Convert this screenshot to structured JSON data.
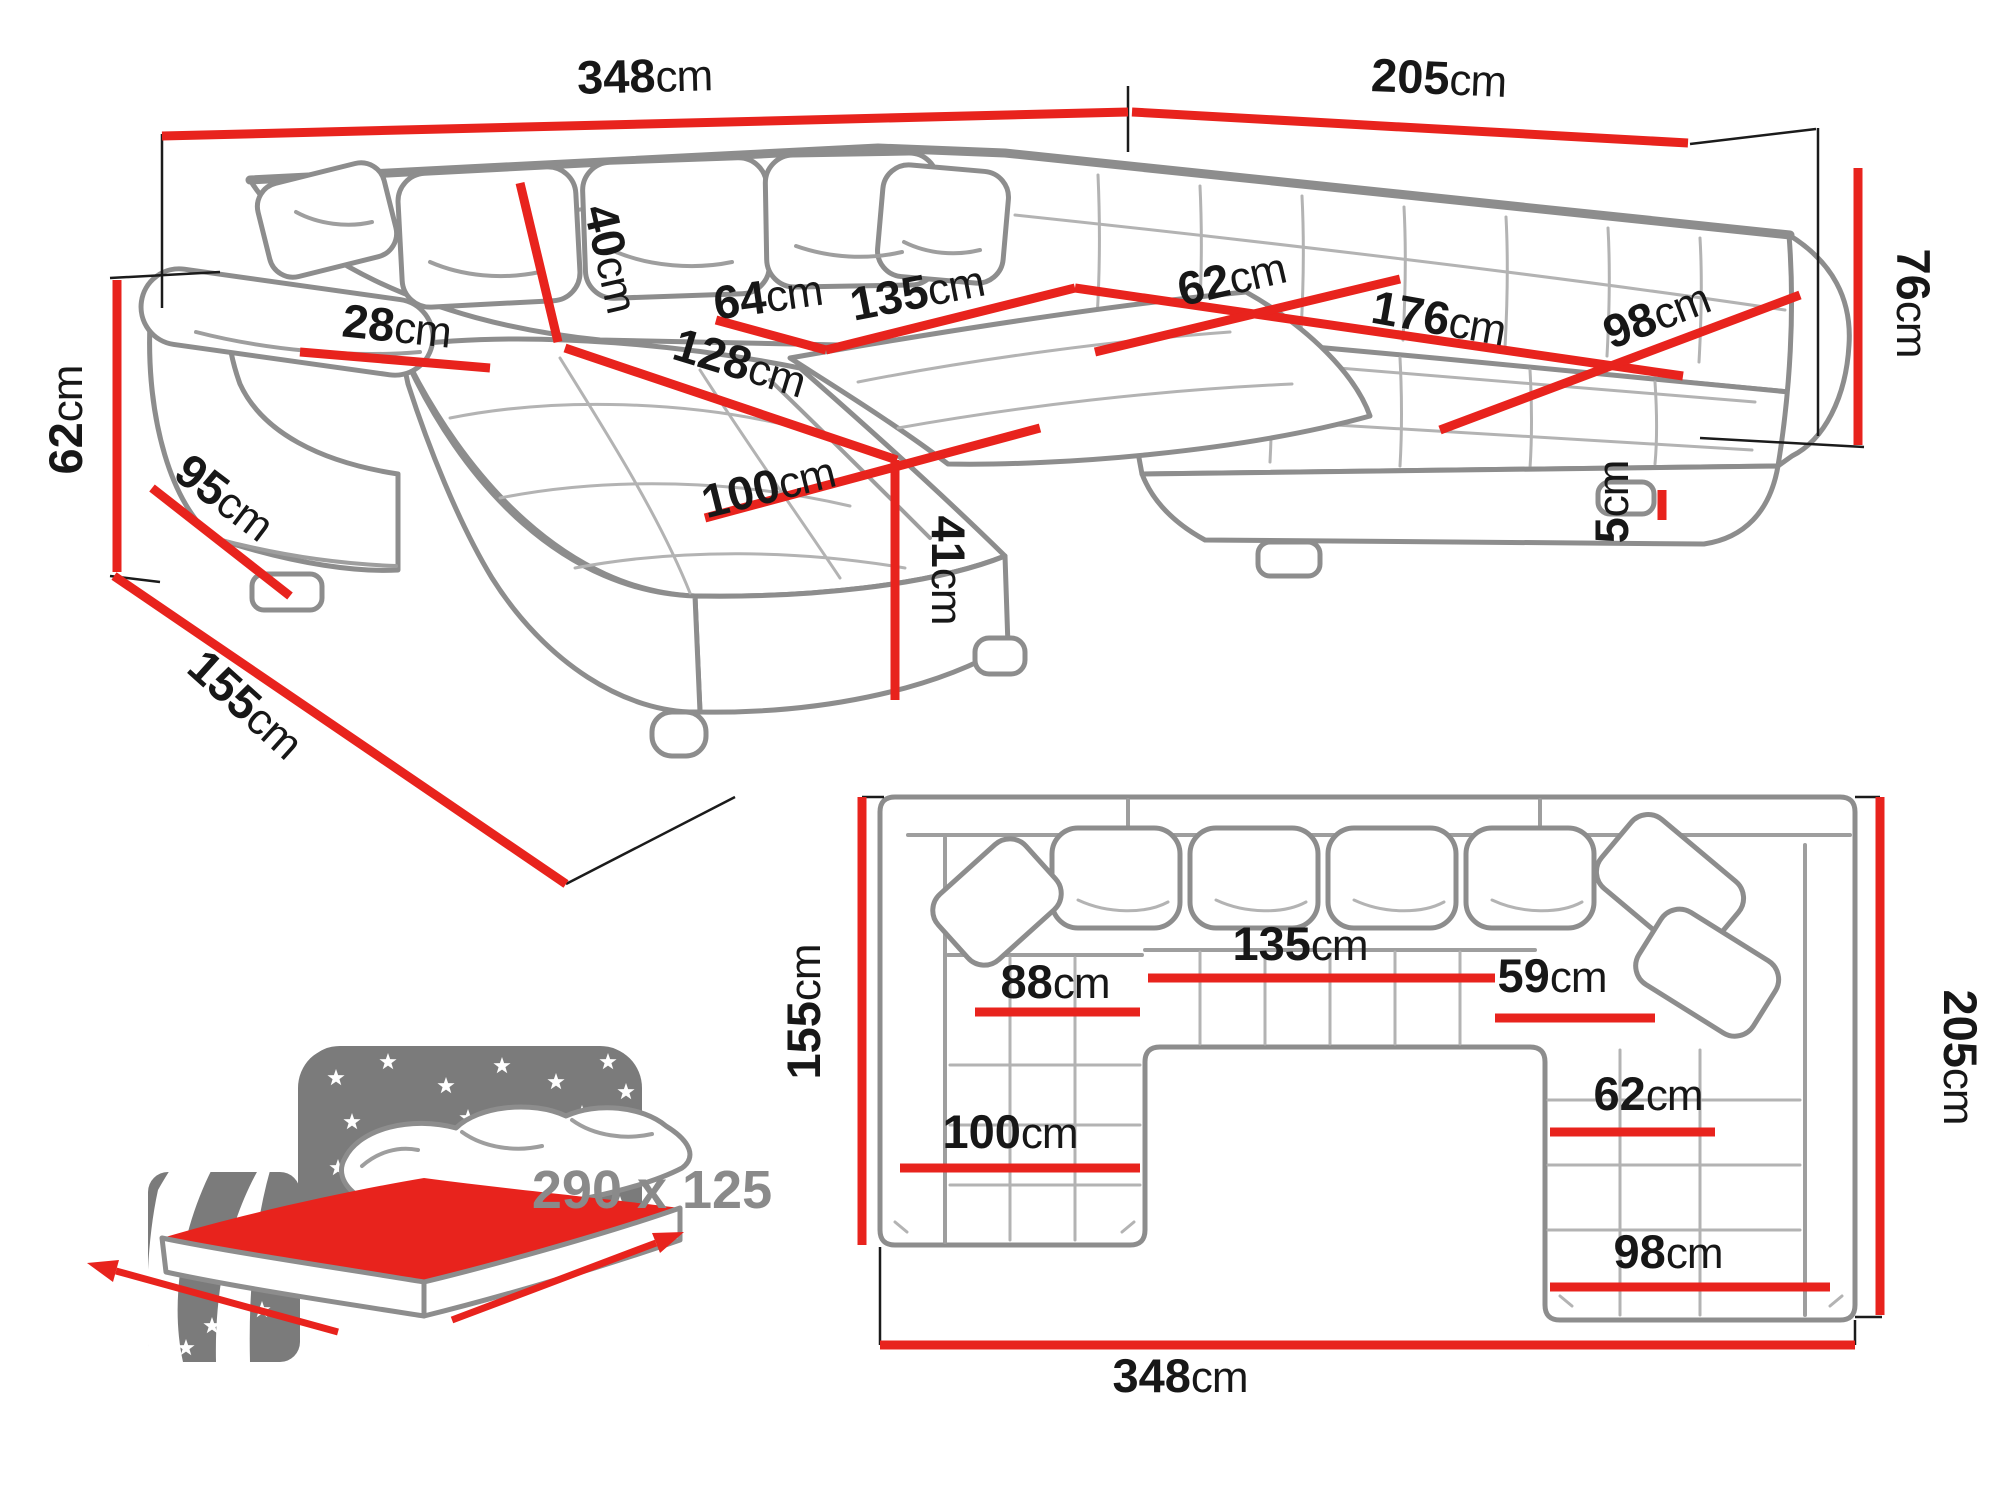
{
  "colors": {
    "dimension_red": "#e8231d",
    "sofa_outline_gray": "#8d8d8d",
    "label_black": "#171717",
    "icon_gray": "#7b7b7b",
    "icon_text_gray": "#8a8a8a"
  },
  "perspective_view": {
    "dims": {
      "total_width": {
        "v": "348",
        "u": "cm"
      },
      "right_width": {
        "v": "205",
        "u": "cm"
      },
      "back_height": {
        "v": "76",
        "u": "cm"
      },
      "arm_height": {
        "v": "62",
        "u": "cm"
      },
      "arm_depth": {
        "v": "95",
        "u": "cm"
      },
      "side_depth": {
        "v": "155",
        "u": "cm"
      },
      "arm_top_width": {
        "v": "28",
        "u": "cm"
      },
      "back_cushion_height": {
        "v": "40",
        "u": "cm"
      },
      "seat_depth": {
        "v": "64",
        "u": "cm"
      },
      "center_seat_width": {
        "v": "135",
        "u": "cm"
      },
      "right_seat_depth": {
        "v": "62",
        "u": "cm"
      },
      "right_seat_width": {
        "v": "176",
        "u": "cm"
      },
      "right_end_width": {
        "v": "98",
        "u": "cm"
      },
      "chaise_length": {
        "v": "128",
        "u": "cm"
      },
      "chaise_width": {
        "v": "100",
        "u": "cm"
      },
      "seat_height": {
        "v": "41",
        "u": "cm"
      },
      "leg_height": {
        "v": "5",
        "u": "cm"
      }
    }
  },
  "plan_view": {
    "dims": {
      "side_depth": {
        "v": "155",
        "u": "cm"
      },
      "right_depth": {
        "v": "205",
        "u": "cm"
      },
      "chaise_inner_width": {
        "v": "88",
        "u": "cm"
      },
      "center_seat_width": {
        "v": "135",
        "u": "cm"
      },
      "right_seat_top_width": {
        "v": "59",
        "u": "cm"
      },
      "right_seat_width": {
        "v": "62",
        "u": "cm"
      },
      "chaise_width": {
        "v": "100",
        "u": "cm"
      },
      "right_end_width": {
        "v": "98",
        "u": "cm"
      },
      "total_width": {
        "v": "348",
        "u": "cm"
      }
    }
  },
  "sleeping_area": {
    "size": "290 x 125"
  }
}
